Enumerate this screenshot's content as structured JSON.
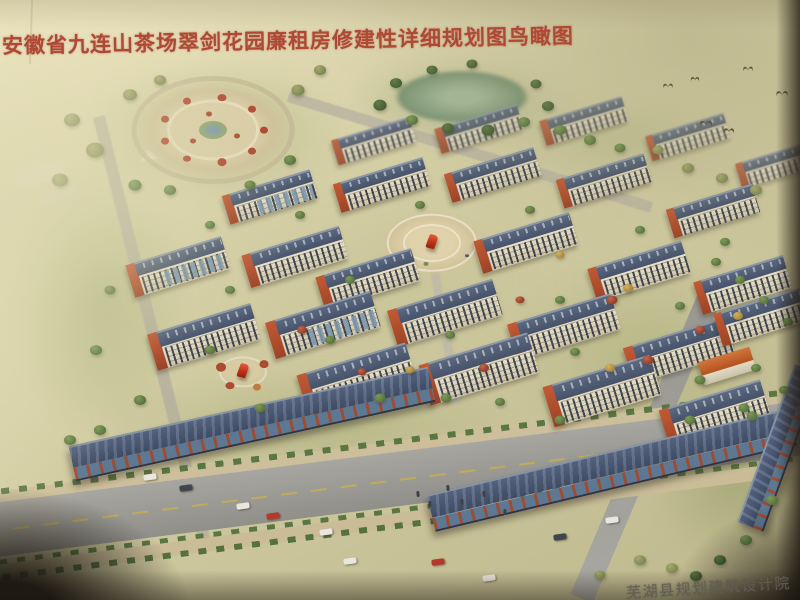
{
  "header": {
    "title": "安徽省九连山茶场翠剑花园廉租房修建性详细规划图鸟瞰图"
  },
  "footer": {
    "credit": "芜湖县规划建筑设计院"
  },
  "palette": {
    "title_red": "#ae4936",
    "page_cream": "#e9e1bc",
    "roof_slate": "#45526a",
    "gable_orange": "#c25a35",
    "facade_cream": "#e7e0ca",
    "commercial_roof": "#3e4b64",
    "pillar_red": "#9e4c34",
    "glass_blue": "#5d7892",
    "road_grey": "#9a9993",
    "water_green": "#8ba283",
    "plaza_tan": "#d9cda6",
    "tree": {
      "g": [
        "#7d9a58",
        "#55713c"
      ],
      "d": [
        "#5e7a45",
        "#3f5a30"
      ],
      "r": [
        "#c2664a",
        "#8e3b26"
      ],
      "y": [
        "#d2b25e",
        "#a5823c"
      ],
      "o": [
        "#a3a96e",
        "#7c8450"
      ]
    },
    "car": {
      "w": "#e9e7dd",
      "r": "#b5392a",
      "d": "#41454c"
    }
  },
  "scene": {
    "greens": [
      [
        215,
        130,
        270,
        140,
        0,
        "rgba(160,172,115,.5)"
      ],
      [
        462,
        102,
        230,
        95,
        0,
        "rgba(138,160,118,.45)"
      ],
      [
        620,
        142,
        260,
        95,
        0,
        "rgba(170,175,125,.4)"
      ],
      [
        100,
        300,
        180,
        270,
        0,
        "rgba(150,165,105,.5)"
      ],
      [
        400,
        280,
        560,
        300,
        0,
        "rgba(186,186,136,.32)"
      ],
      [
        650,
        360,
        280,
        210,
        0,
        "rgba(158,168,110,.4)"
      ],
      [
        310,
        425,
        430,
        120,
        0,
        "rgba(150,160,100,.4)"
      ],
      [
        735,
        485,
        170,
        150,
        0,
        "rgba(138,148,95,.45)"
      ]
    ],
    "roads": [
      [
        152,
        330,
        440,
        12,
        76,
        "#b2ad9d",
        "soft"
      ],
      [
        470,
        152,
        380,
        11,
        17,
        "#b6b1a1",
        "soft"
      ],
      [
        445,
        330,
        150,
        9,
        80,
        "#bdb8a8",
        "soft"
      ],
      [
        648,
        442,
        340,
        24,
        -67,
        "linear-gradient(90deg,#a8a7a1,#97968f)",
        ""
      ],
      [
        400,
        447,
        850,
        13,
        -7.2,
        "#cdbf9b",
        ""
      ],
      [
        400,
        441,
        840,
        6,
        -7.2,
        "repeating-linear-gradient(90deg,#5a7742 0 8px,rgba(0,0,0,0) 8px 18px)",
        ""
      ],
      [
        398,
        479,
        870,
        54,
        -7.2,
        "linear-gradient(180deg,#a7a6a0,#908f89)",
        "main"
      ],
      [
        390,
        512,
        860,
        6,
        -7.4,
        "repeating-linear-gradient(90deg,#5a7742 0 8px,rgba(0,0,0,0) 8px 18px)",
        ""
      ],
      [
        382,
        522,
        860,
        14,
        -7.4,
        "#c9bc97",
        ""
      ],
      [
        250,
        545,
        500,
        6,
        -7.4,
        "repeating-linear-gradient(90deg,#54713e 0 8px,rgba(0,0,0,0) 8px 18px)",
        ""
      ]
    ],
    "pond": {
      "cx": 462,
      "cy": 97,
      "rx": 68,
      "ry": 27
    },
    "plazas": [
      {
        "cx": 213,
        "cy": 130,
        "rx": 78,
        "ry": 50,
        "base": "radial-gradient(closest-side,#d9cda6 55%,#cfc29a 78%,rgba(207,194,154,0) 100%)",
        "rings": [
          {
            "f": 0.98,
            "w": 5,
            "c": "rgba(196,186,150,.9)"
          },
          {
            "f": 0.55,
            "w": 3,
            "c": "rgba(232,224,192,.8)"
          }
        ],
        "center": {
          "rx": 14,
          "ry": 9,
          "c": "radial-gradient(closest-side,#7d98a8 35%,#8fa470 80%)"
        },
        "dots": [
          {
            "a": 0,
            "f": 0.66,
            "s": 8,
            "c": "#b04832"
          },
          {
            "a": 40,
            "f": 0.66,
            "s": 8,
            "c": "#b04832"
          },
          {
            "a": 80,
            "f": 0.66,
            "s": 9,
            "c": "#b04832"
          },
          {
            "a": 120,
            "f": 0.66,
            "s": 8,
            "c": "#b04832"
          },
          {
            "a": 160,
            "f": 0.66,
            "s": 8,
            "c": "#b04832"
          },
          {
            "a": 200,
            "f": 0.66,
            "s": 8,
            "c": "#b04832"
          },
          {
            "a": 240,
            "f": 0.66,
            "s": 8,
            "c": "#b04832"
          },
          {
            "a": 280,
            "f": 0.66,
            "s": 9,
            "c": "#b04832"
          },
          {
            "a": 320,
            "f": 0.66,
            "s": 8,
            "c": "#b04832"
          },
          {
            "a": 20,
            "f": 0.33,
            "s": 6,
            "c": "#a84a30"
          },
          {
            "a": 140,
            "f": 0.33,
            "s": 6,
            "c": "#a84a30"
          },
          {
            "a": 260,
            "f": 0.33,
            "s": 6,
            "c": "#a84a30"
          }
        ]
      },
      {
        "cx": 432,
        "cy": 243,
        "rx": 54,
        "ry": 34,
        "base": "radial-gradient(closest-side,#e0d3ab 40%,#d3c49c 75%,rgba(211,196,156,0) 100%)",
        "rings": [
          {
            "f": 0.8,
            "w": 2,
            "c": "rgba(246,241,221,.6)"
          },
          {
            "f": 0.5,
            "w": 2,
            "c": "rgba(246,241,221,.6)"
          }
        ],
        "sculpture": true,
        "dots": [
          {
            "a": 100,
            "f": 0.62,
            "s": 5,
            "c": "#7a8a60"
          },
          {
            "a": 150,
            "f": 0.7,
            "s": 5,
            "c": "#7a8a60"
          },
          {
            "a": 30,
            "f": 0.75,
            "s": 4,
            "c": "#55606e"
          }
        ]
      },
      {
        "cx": 243,
        "cy": 372,
        "rx": 26,
        "ry": 16,
        "base": "radial-gradient(closest-side,#d8cba3 55%,rgba(216,203,163,0) 100%)",
        "rings": [
          {
            "f": 0.85,
            "w": 2,
            "c": "rgba(240,235,215,.55)"
          }
        ],
        "sculpture": true,
        "dots": [
          {
            "a": 200,
            "f": 0.9,
            "s": 10,
            "c": "#ad4a30"
          },
          {
            "a": 330,
            "f": 0.95,
            "s": 9,
            "c": "#ad4a30"
          },
          {
            "a": 120,
            "f": 1.0,
            "s": 9,
            "c": "#ad4a30"
          },
          {
            "a": 60,
            "f": 1.1,
            "s": 8,
            "c": "#c27b3e"
          }
        ]
      }
    ],
    "buildings": [
      [
        333,
        128,
        82,
        26,
        1
      ],
      [
        436,
        116,
        86,
        26,
        1
      ],
      [
        541,
        108,
        86,
        26,
        1
      ],
      [
        647,
        124,
        82,
        26,
        1
      ],
      [
        737,
        152,
        78,
        26,
        1
      ],
      [
        224,
        182,
        92,
        30,
        2
      ],
      [
        335,
        170,
        94,
        30,
        0
      ],
      [
        446,
        160,
        94,
        30,
        0
      ],
      [
        558,
        166,
        92,
        30,
        0
      ],
      [
        668,
        196,
        90,
        30,
        0
      ],
      [
        128,
        250,
        100,
        34,
        2
      ],
      [
        244,
        240,
        102,
        34,
        0
      ],
      [
        318,
        262,
        100,
        34,
        0
      ],
      [
        476,
        226,
        100,
        34,
        0
      ],
      [
        590,
        254,
        98,
        34,
        0
      ],
      [
        696,
        268,
        94,
        34,
        0
      ],
      [
        150,
        318,
        108,
        38,
        0
      ],
      [
        268,
        306,
        110,
        38,
        2
      ],
      [
        390,
        294,
        110,
        38,
        0
      ],
      [
        510,
        308,
        108,
        38,
        0
      ],
      [
        626,
        332,
        106,
        38,
        0
      ],
      [
        300,
        358,
        114,
        42,
        0
      ],
      [
        422,
        348,
        114,
        42,
        0
      ],
      [
        546,
        370,
        112,
        42,
        0
      ],
      [
        662,
        394,
        106,
        40,
        0
      ],
      [
        716,
        300,
        92,
        34,
        0
      ],
      [
        700,
        354,
        54,
        24,
        3
      ]
    ],
    "strips": [
      [
        252,
        424,
        368,
        36,
        -12.5
      ],
      [
        612,
        470,
        372,
        38,
        -13.5
      ],
      [
        779,
        448,
        168,
        28,
        -70
      ]
    ],
    "trees": [
      [
        72,
        120,
        16,
        "o"
      ],
      [
        95,
        150,
        18,
        "o"
      ],
      [
        60,
        180,
        16,
        "o"
      ],
      [
        130,
        95,
        14,
        "o"
      ],
      [
        160,
        80,
        12,
        "o"
      ],
      [
        298,
        90,
        13,
        "o"
      ],
      [
        320,
        70,
        12,
        "o"
      ],
      [
        135,
        185,
        13,
        "g"
      ],
      [
        290,
        160,
        12,
        "g"
      ],
      [
        250,
        185,
        11,
        "g"
      ],
      [
        170,
        190,
        12,
        "g"
      ],
      [
        396,
        83,
        12,
        "d"
      ],
      [
        380,
        105,
        13,
        "d"
      ],
      [
        412,
        120,
        12,
        "g"
      ],
      [
        448,
        128,
        12,
        "d"
      ],
      [
        488,
        130,
        13,
        "d"
      ],
      [
        524,
        122,
        12,
        "g"
      ],
      [
        548,
        106,
        12,
        "d"
      ],
      [
        536,
        84,
        11,
        "d"
      ],
      [
        432,
        70,
        11,
        "d"
      ],
      [
        472,
        64,
        11,
        "d"
      ],
      [
        560,
        130,
        12,
        "g"
      ],
      [
        590,
        140,
        12,
        "g"
      ],
      [
        620,
        148,
        11,
        "g"
      ],
      [
        688,
        168,
        12,
        "o"
      ],
      [
        722,
        178,
        12,
        "o"
      ],
      [
        756,
        190,
        12,
        "o"
      ],
      [
        658,
        150,
        11,
        "o"
      ],
      [
        210,
        225,
        10,
        "g"
      ],
      [
        300,
        215,
        10,
        "g"
      ],
      [
        420,
        205,
        10,
        "g"
      ],
      [
        530,
        210,
        10,
        "g"
      ],
      [
        640,
        230,
        10,
        "g"
      ],
      [
        725,
        242,
        10,
        "g"
      ],
      [
        110,
        290,
        11,
        "g"
      ],
      [
        230,
        290,
        10,
        "g"
      ],
      [
        350,
        280,
        10,
        "g"
      ],
      [
        560,
        300,
        10,
        "g"
      ],
      [
        680,
        306,
        10,
        "g"
      ],
      [
        96,
        350,
        12,
        "g"
      ],
      [
        210,
        350,
        11,
        "g"
      ],
      [
        330,
        340,
        10,
        "g"
      ],
      [
        450,
        335,
        10,
        "g"
      ],
      [
        575,
        352,
        10,
        "g"
      ],
      [
        700,
        380,
        11,
        "g"
      ],
      [
        140,
        400,
        12,
        "g"
      ],
      [
        260,
        408,
        11,
        "g"
      ],
      [
        380,
        398,
        11,
        "g"
      ],
      [
        500,
        402,
        10,
        "g"
      ],
      [
        612,
        300,
        11,
        "r"
      ],
      [
        628,
        288,
        10,
        "y"
      ],
      [
        648,
        360,
        11,
        "r"
      ],
      [
        610,
        368,
        10,
        "y"
      ],
      [
        700,
        330,
        10,
        "r"
      ],
      [
        738,
        316,
        10,
        "y"
      ],
      [
        302,
        330,
        10,
        "r"
      ],
      [
        362,
        372,
        9,
        "r"
      ],
      [
        410,
        370,
        9,
        "y"
      ],
      [
        484,
        368,
        10,
        "r"
      ],
      [
        520,
        300,
        9,
        "r"
      ],
      [
        560,
        255,
        9,
        "y"
      ],
      [
        70,
        440,
        12,
        "g"
      ],
      [
        100,
        430,
        12,
        "g"
      ],
      [
        446,
        398,
        11,
        "g"
      ],
      [
        560,
        420,
        11,
        "g"
      ],
      [
        690,
        420,
        11,
        "g"
      ],
      [
        744,
        408,
        11,
        "g"
      ],
      [
        716,
        262,
        10,
        "g"
      ],
      [
        740,
        280,
        10,
        "g"
      ],
      [
        764,
        300,
        10,
        "g"
      ],
      [
        788,
        322,
        10,
        "g"
      ],
      [
        756,
        368,
        10,
        "g"
      ],
      [
        784,
        390,
        10,
        "g"
      ],
      [
        752,
        416,
        11,
        "g"
      ],
      [
        772,
        500,
        12,
        "g"
      ],
      [
        746,
        540,
        12,
        "g"
      ],
      [
        720,
        560,
        12,
        "d"
      ],
      [
        696,
        576,
        12,
        "d"
      ],
      [
        640,
        560,
        12,
        "o"
      ],
      [
        600,
        575,
        11,
        "o"
      ],
      [
        672,
        568,
        12,
        "o"
      ]
    ],
    "cars": [
      [
        150,
        477,
        "w"
      ],
      [
        186,
        488,
        "d"
      ],
      [
        243,
        506,
        "w"
      ],
      [
        273,
        516,
        "r"
      ],
      [
        326,
        532,
        "w"
      ],
      [
        350,
        561,
        "w"
      ],
      [
        438,
        562,
        "r"
      ],
      [
        489,
        578,
        "w"
      ],
      [
        560,
        537,
        "d"
      ],
      [
        612,
        520,
        "w"
      ]
    ],
    "people": [
      [
        418,
        494
      ],
      [
        430,
        504
      ],
      [
        462,
        502
      ],
      [
        505,
        512
      ],
      [
        484,
        494
      ],
      [
        448,
        488
      ]
    ],
    "birds": [
      [
        668,
        84,
        10
      ],
      [
        695,
        77,
        9
      ],
      [
        748,
        67,
        10
      ],
      [
        782,
        92,
        12
      ],
      [
        706,
        122,
        13
      ],
      [
        729,
        129,
        11
      ]
    ]
  }
}
